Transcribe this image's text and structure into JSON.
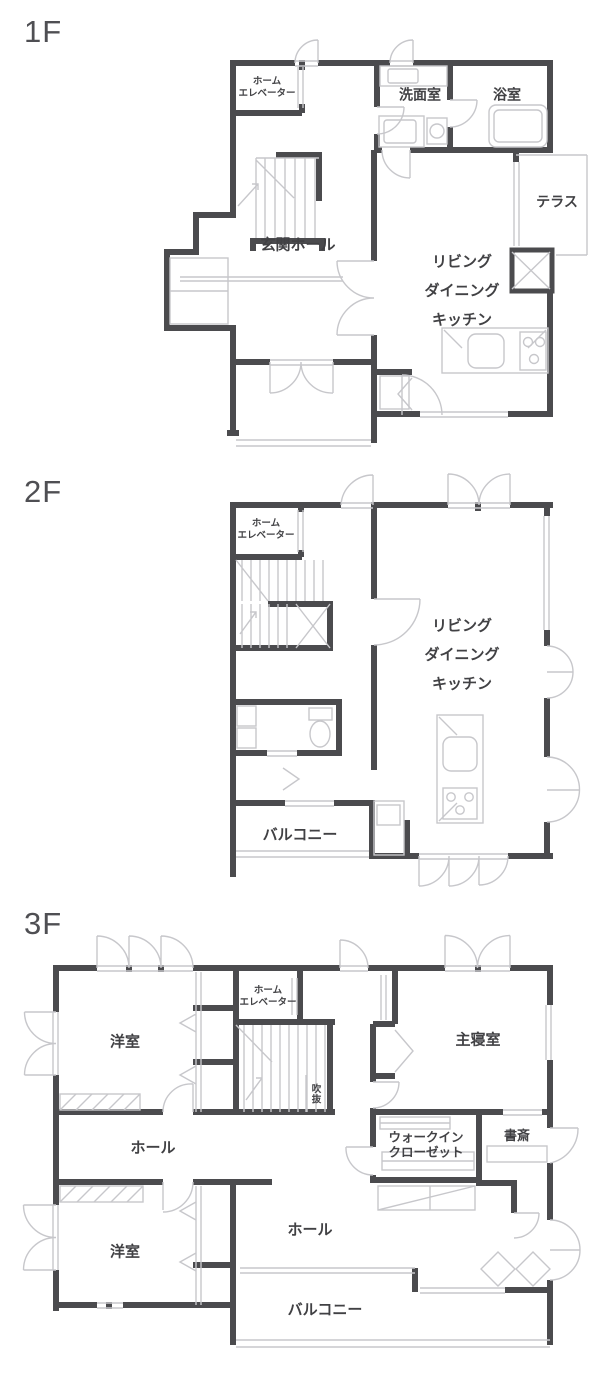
{
  "colors": {
    "wall": "#4b4b4e",
    "line": "#c7c7cb",
    "text": "#414144",
    "floor_label": "#4f4f53",
    "background": "#ffffff"
  },
  "floors": [
    {
      "label": "1F",
      "rooms": {
        "elevator": "ホーム\nエレベーター",
        "washroom": "洗面室",
        "bathroom": "浴室",
        "terrace": "テラス",
        "entrance_hall": "玄関ホール",
        "ldk": "リビング\nダイニング\nキッチン"
      }
    },
    {
      "label": "2F",
      "rooms": {
        "elevator": "ホーム\nエレベーター",
        "ldk": "リビング\nダイニング\nキッチン",
        "balcony": "バルコニー"
      }
    },
    {
      "label": "3F",
      "rooms": {
        "western_room_1": "洋室",
        "elevator": "ホーム\nエレベーター",
        "master_bedroom": "主寝室",
        "void": "吹抜",
        "hall_upper": "ホール",
        "walk_in_closet": "ウォークイン\nクローゼット",
        "study": "書斎",
        "western_room_2": "洋室",
        "hall_lower": "ホール",
        "balcony": "バルコニー"
      }
    }
  ]
}
